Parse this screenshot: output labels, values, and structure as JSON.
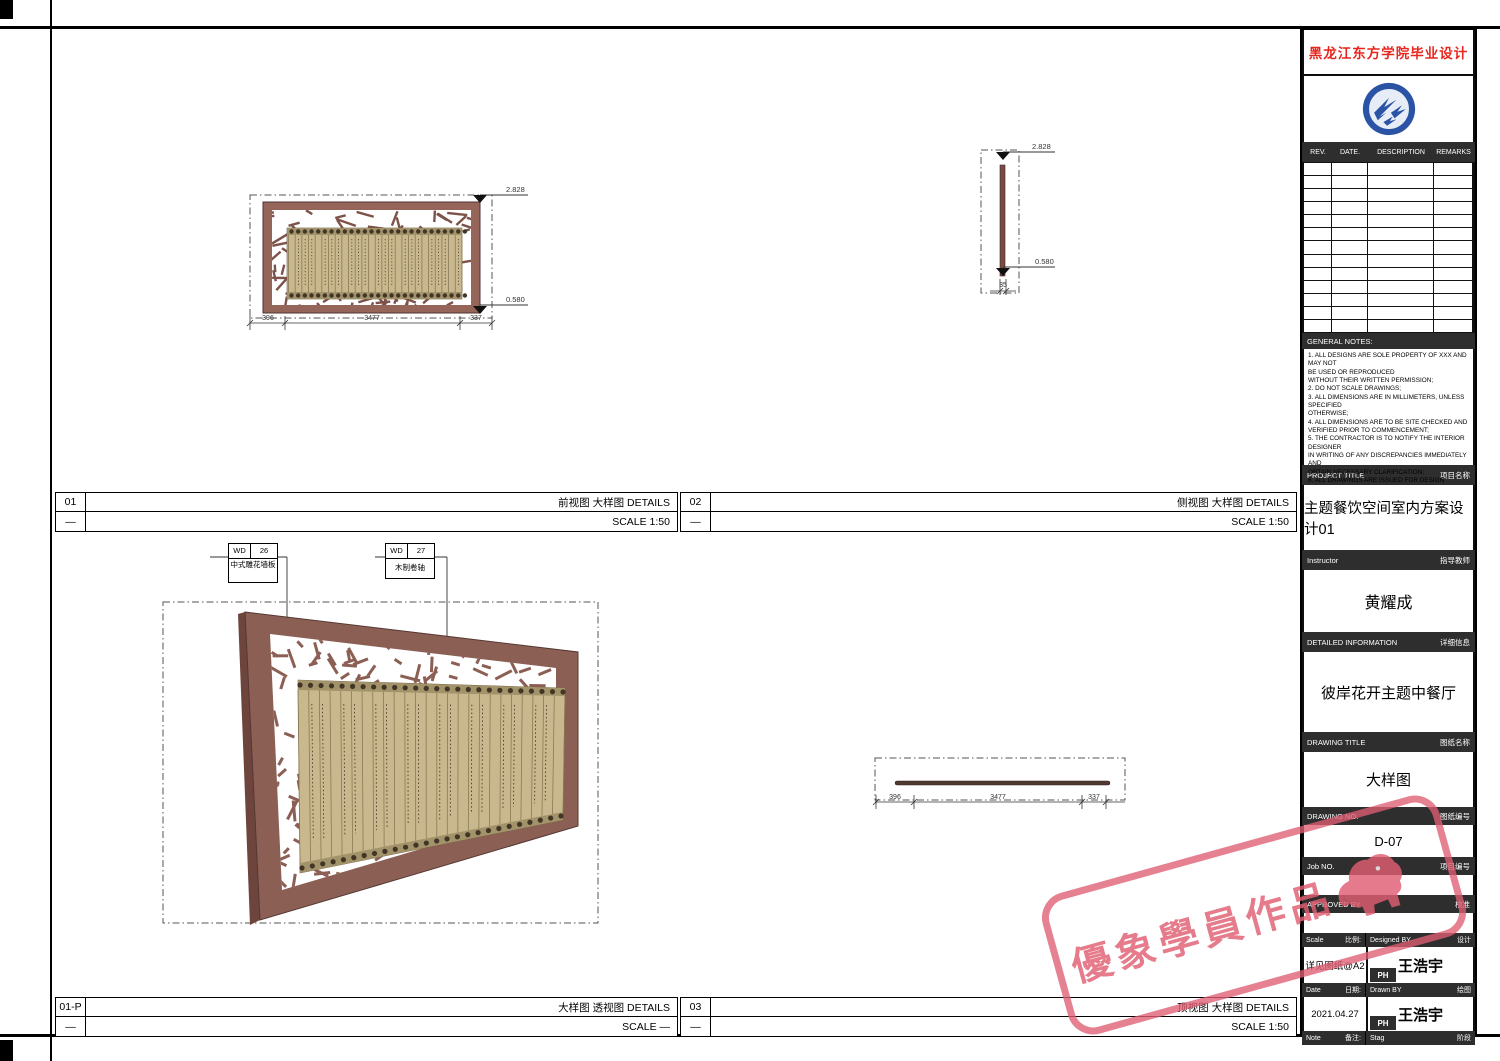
{
  "panels": [
    {
      "no": "01",
      "dash": "—",
      "title": "前视图  大样图 DETAILS",
      "scale": "SCALE 1:50"
    },
    {
      "no": "02",
      "dash": "—",
      "title": "侧视图  大样图 DETAILS",
      "scale": "SCALE 1:50"
    },
    {
      "no": "01-P",
      "dash": "—",
      "title": "大样图 透视图 DETAILS",
      "scale": "SCALE —"
    },
    {
      "no": "03",
      "dash": "—",
      "title": "顶视图  大样图 DETAILS",
      "scale": "SCALE 1:50"
    }
  ],
  "front_view": {
    "elev_top": "2.828",
    "elev_bottom": "0.580",
    "dim_left": "396",
    "dim_mid": "3477",
    "dim_right": "337"
  },
  "side_view": {
    "elev_top": "2.828",
    "elev_bottom": "0.580",
    "dim_width": "35"
  },
  "top_view": {
    "dim_left": "396",
    "dim_mid": "3477",
    "dim_right": "337"
  },
  "perspective": {
    "callouts": [
      {
        "code": "WD",
        "num": "26",
        "label": "中式雕花墙板"
      },
      {
        "code": "WD",
        "num": "27",
        "label": "木制卷轴"
      }
    ]
  },
  "titleblock": {
    "school": "黑龙江东方学院毕业设计",
    "rev_headers": [
      "REV.",
      "DATE.",
      "DESCRIPTION",
      "REMARKS"
    ],
    "notes_title": "GENERAL NOTES:",
    "notes": [
      "1. ALL DESIGNS ARE SOLE PROPERTY OF XXX AND MAY NOT",
      "    BE USED OR REPRODUCED",
      "    WITHOUT THEIR WRITTEN PERMISSION;",
      "2. DO NOT SCALE DRAWINGS;",
      "3. ALL DIMENSIONS ARE IN MILLIMETERS, UNLESS SPECIFIED",
      "    OTHERWISE;",
      "4. ALL DIMENSIONS ARE TO BE SITE CHECKED AND",
      "    VERIFIED PRIOR TO COMMENCEMENT;",
      "5. THE CONTRACTOR IS TO NOTIFY THE INTERIOR DESIGNER",
      "    IN WRITING OF ANY DISCREPANCIES IMMEDIATELY AND",
      "    OBTAIN NECESSARY CLARIFICATION;",
      "6. ALL DRAWINGS ARE ISSUED FOR DESIGN INTENT AND",
      "    WHERE REQUIRED ARE TO BE DEVELOPED BY THE",
      "    CONTRACTOR ACCORDINGLY INTO SHOP/FABRICATION",
      "    DRAWINGS."
    ],
    "project": {
      "en": "PROJECT TITLE",
      "zh": "项目名称",
      "value": "主题餐饮空间室内方案设计01"
    },
    "instructor": {
      "en": "Instructor",
      "zh": "指导教师",
      "value": "黄耀成"
    },
    "detailed": {
      "en": "DETAILED INFORMATION",
      "zh": "详细信息",
      "value": "彼岸花开主题中餐厅"
    },
    "drawing_title": {
      "en": "DRAWING TITLE",
      "zh": "图纸名称",
      "value": "大样图"
    },
    "drawing_no": {
      "en": "DRAWING NO.",
      "zh": "图纸编号",
      "value": "D-07"
    },
    "job_no": {
      "en": "Job NO.",
      "zh": "项目编号",
      "value": ""
    },
    "approved": {
      "en": "APPROVED BY",
      "zh": "校准",
      "value": ""
    },
    "scale_row": {
      "en": "Scale",
      "zh": "比例:",
      "right_en": "Designed BY",
      "right_zh": "设计",
      "value": "详见图纸@A2",
      "ph": "PH",
      "name": "王浩宇"
    },
    "date_row": {
      "en": "Date",
      "zh": "日期:",
      "right_en": "Drawn BY",
      "right_zh": "绘图",
      "value": "2021.04.27",
      "ph": "PH",
      "name": "王浩宇"
    },
    "note_row": {
      "en": "Note",
      "zh": "备注:",
      "right_en": "Stag",
      "right_zh": "阶段"
    }
  },
  "watermark": {
    "text": "優象學員作品"
  },
  "colors": {
    "accent_red": "#e8251d",
    "frame_brown": "#96655a",
    "scroll_tan": "#c9b88d",
    "logo_blue": "#2b53a5",
    "watermark_pink": "#df5e72"
  }
}
